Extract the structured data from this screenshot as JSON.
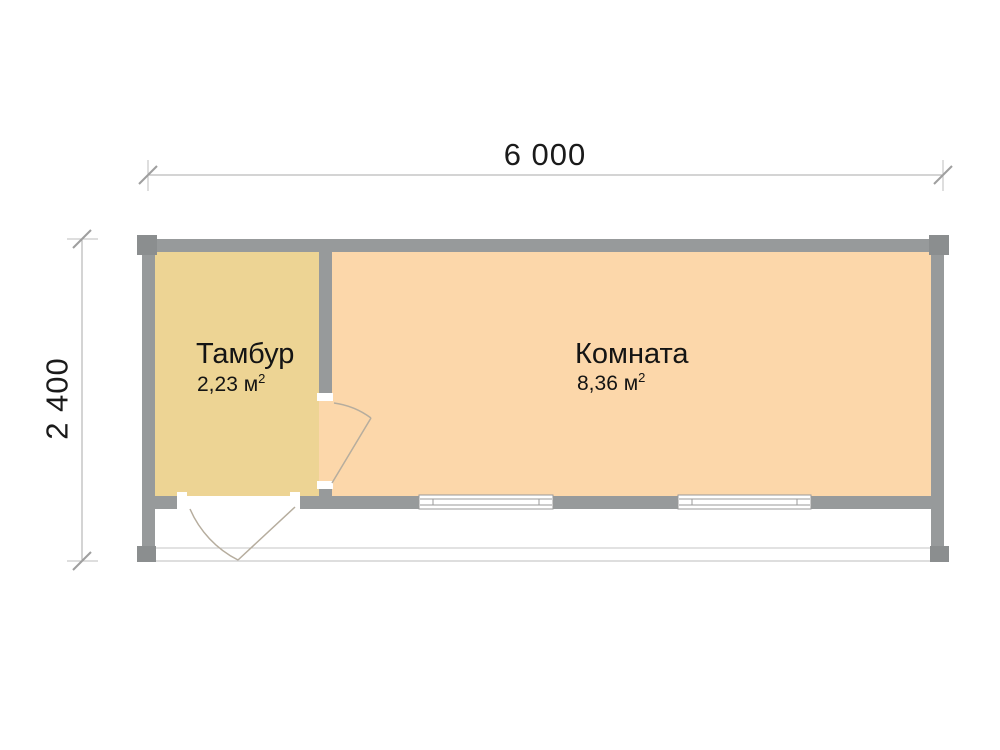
{
  "plan": {
    "dimensions": {
      "width_label": "6 000",
      "height_label": "2 400"
    },
    "rooms": [
      {
        "name": "Тамбур",
        "area_value": "2,23 м",
        "area_sup": "2",
        "fill": "#edd494"
      },
      {
        "name": "Комната",
        "area_value": "8,36 м",
        "area_sup": "2",
        "fill": "#fcd7aa"
      }
    ],
    "colors": {
      "wall": "#979a9b",
      "corner_post": "#8b8e8f",
      "tambur_fill": "#edd494",
      "komnata_fill": "#fcd7aa",
      "dimension_line": "#a9a9a9",
      "tick_slash": "#9f9f9f",
      "door_swing": "#b6ad9e",
      "deck_line": "#c6c6c6",
      "window_frame": "#9a9a9a",
      "text": "#141414"
    }
  }
}
